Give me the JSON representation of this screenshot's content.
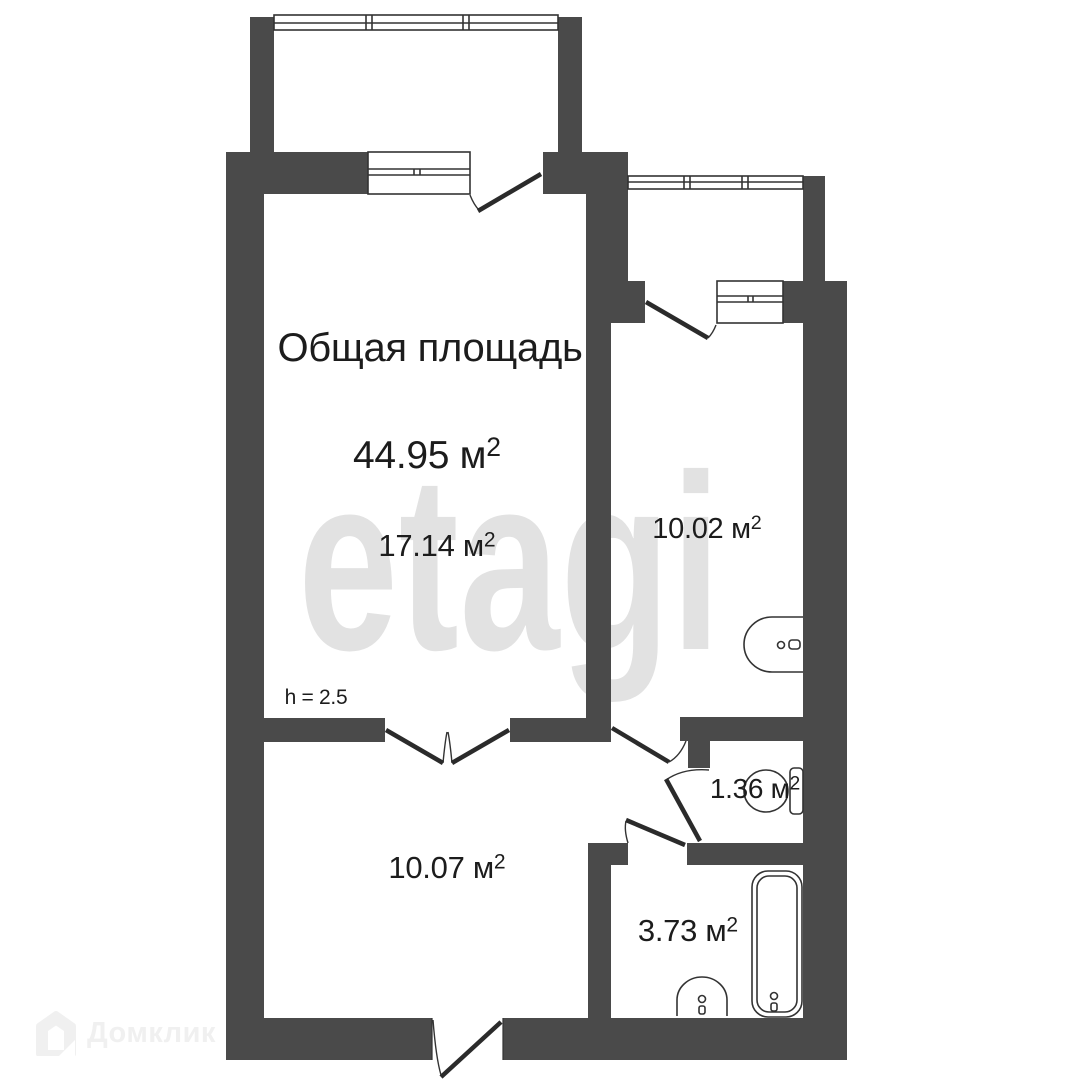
{
  "colors": {
    "bg": "#ffffff",
    "wall": "#4a4a4a",
    "line": "#333333",
    "leaf": "#2b2b2b",
    "text": "#1c1c1c",
    "watermark": "#e2e2e2",
    "logo": "#f0f0f0"
  },
  "header": {
    "total_label": "Общая площадь",
    "total_area": "44.95 м",
    "total_sup": "2"
  },
  "rooms": {
    "living": {
      "area": "17.14 м",
      "sup": "2"
    },
    "bedroom": {
      "area": "10.02 м",
      "sup": "2"
    },
    "lower": {
      "area": "10.07 м",
      "sup": "2"
    },
    "wc": {
      "area": "1.36 м",
      "sup": "2"
    },
    "bathroom": {
      "area": "3.73 м",
      "sup": "2"
    }
  },
  "height_note": "h = 2.5",
  "watermark": {
    "text": "etagi"
  },
  "branding": {
    "name": "Домклик"
  },
  "icons": {
    "bedroom_fixture": "sink-icon",
    "wc_fixture": "toilet-icon",
    "bathroom_fixture_1": "bathtub-icon",
    "bathroom_fixture_2": "washbasin-icon",
    "brand_icon": "house-icon"
  }
}
